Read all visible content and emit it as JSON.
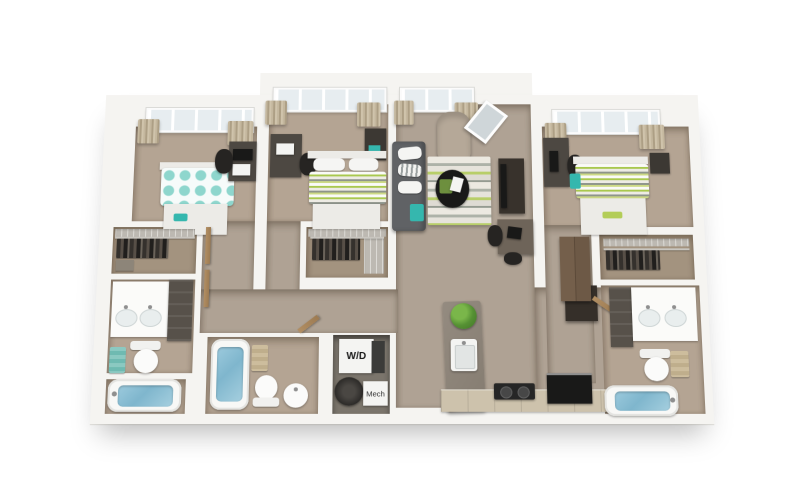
{
  "floor_plan": {
    "labels": {
      "washer_dryer": "W/D",
      "mechanical": "Mech"
    },
    "palette": {
      "background": "#ffffff",
      "wall_white": "#f5f4f1",
      "wood_floor": "#b4a493",
      "closet_floor": "#a3937f",
      "utility_floor": "#7b756c",
      "accent_teal": "#35b7ae",
      "teal_bed": "#7bd0c7",
      "accent_lime": "#b3cd57",
      "stripe_lime": "#a9c84e",
      "sofa_gray": "#606265",
      "water_blue": "#7fb6cd",
      "curtain_beige": "#c4b79e",
      "island_gray": "#8b8278",
      "counter_wood": "#cdc2ac",
      "appliance_black": "#191918",
      "door_tan": "#b18e63"
    },
    "rooms": [
      {
        "name": "bedroom-left",
        "fixtures": [
          "teal patterned bed",
          "desk",
          "tv",
          "office chair",
          "window with curtains"
        ]
      },
      {
        "name": "bedroom-middle",
        "fixtures": [
          "striped bed",
          "desk",
          "office chair",
          "nightstand",
          "window with curtains"
        ]
      },
      {
        "name": "living-room",
        "fixtures": [
          "sofa",
          "striped rug",
          "round coffee table",
          "accent chair",
          "leaning mirror",
          "tv stand",
          "study desk",
          "window with curtains"
        ]
      },
      {
        "name": "bedroom-right",
        "fixtures": [
          "striped bed",
          "desk with monitor",
          "office chair",
          "nightstand",
          "window with curtains"
        ]
      },
      {
        "name": "closet-left",
        "fixtures": [
          "hanging clothes",
          "wire shelving"
        ]
      },
      {
        "name": "closet-middle",
        "fixtures": [
          "hanging clothes",
          "wire shelving"
        ]
      },
      {
        "name": "closet-right",
        "fixtures": [
          "hanging clothes",
          "wire shelving"
        ]
      },
      {
        "name": "bathroom-left",
        "fixtures": [
          "double vanity",
          "toilet",
          "bathtub"
        ]
      },
      {
        "name": "bathroom-middle",
        "fixtures": [
          "bathtub",
          "toilet",
          "pedestal sink"
        ]
      },
      {
        "name": "bathroom-right",
        "fixtures": [
          "double vanity",
          "toilet",
          "bathtub"
        ]
      },
      {
        "name": "laundry-closet",
        "fixtures": [
          "washer-dryer",
          "water heater"
        ]
      },
      {
        "name": "kitchen",
        "fixtures": [
          "island with sink and plant",
          "cooktop",
          "refrigerator",
          "pantry cabinet",
          "counter"
        ]
      }
    ]
  }
}
